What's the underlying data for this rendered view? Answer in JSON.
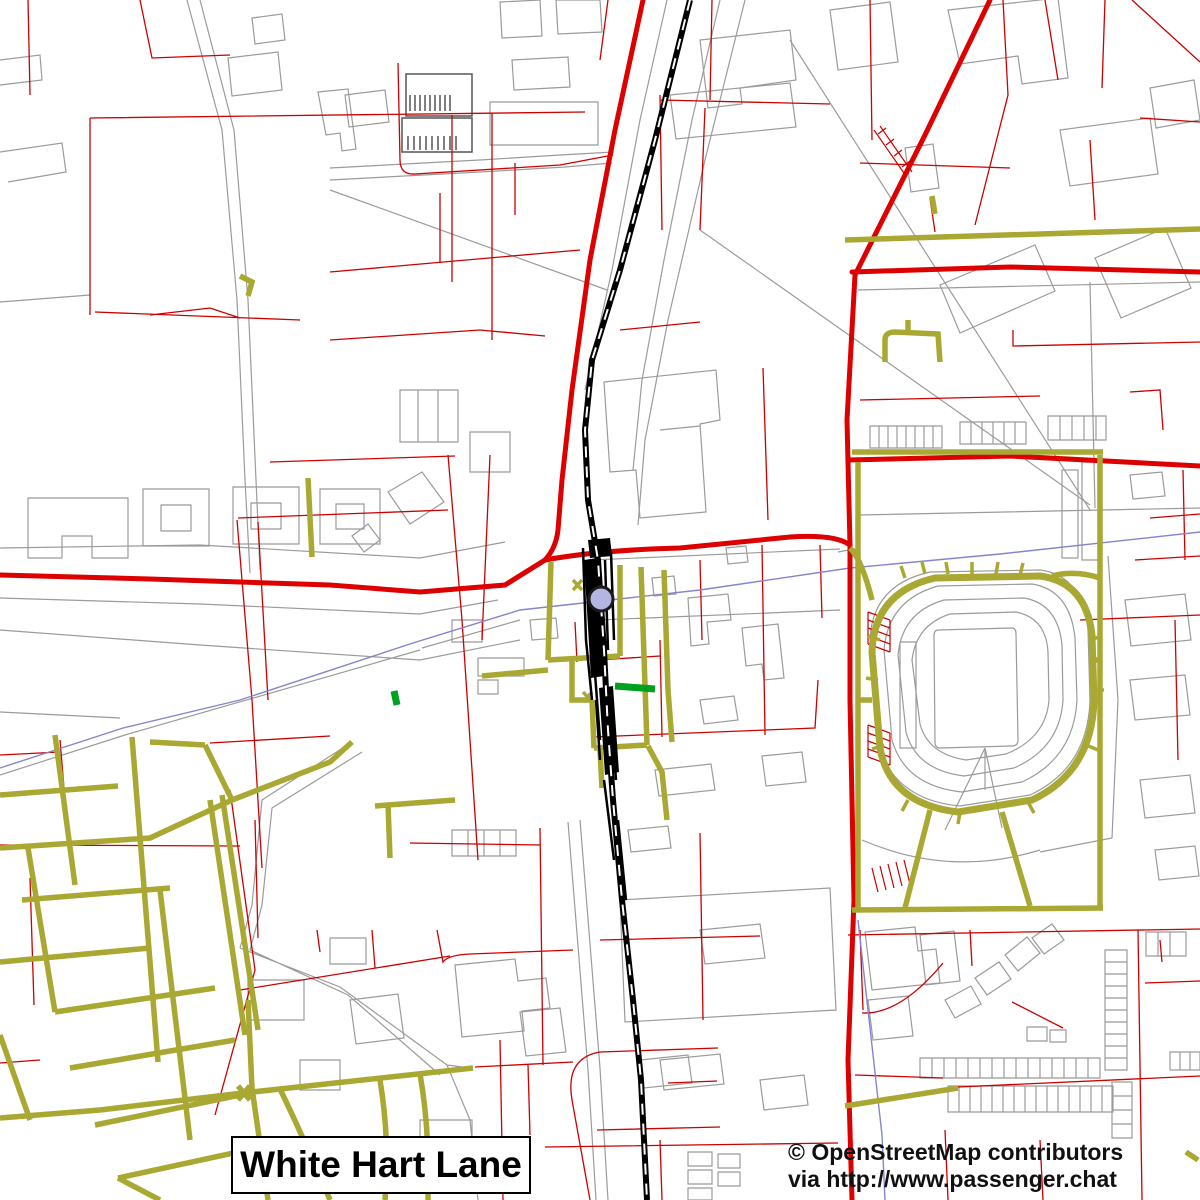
{
  "title": {
    "label": "White Hart Lane"
  },
  "attribution": {
    "line1": "© OpenStreetMap contributors",
    "line2": "via http://www.passenger.chat"
  },
  "colors": {
    "background": "#ffffff",
    "primary_road": "#dd0000",
    "minor_road": "#cc0000",
    "footpath": "#a8a832",
    "railway": "#000000",
    "water_boundary": "#8585cc",
    "building_outline": "#9b9b9b",
    "station_marker_fill": "#b5b5e2",
    "station_marker_stroke": "#1a1a1a",
    "park_feature": "#00a020"
  },
  "map": {
    "viewbox": "0 0 1200 1200",
    "layers": [
      {
        "name": "parcel-and-building-outlines",
        "color": "#9b9b9b",
        "width": 1.2,
        "paths": [
          "M187,0 L222,130 L237,300 L245,480 L250,573 M200,0 L234,130 L248,300 L256,480 L260,570",
          "M745,0 L705,160 L668,320 L645,440 L638,525 M720,0 L692,120 L664,260 L642,380 L633,470",
          "M667,0 L640,120 L612,270 L585,390",
          "M0,548 L200,545 L420,558 L505,542 M0,598 L200,604 L420,614 L498,600",
          "M330,168 L480,160 L560,155 L614,152 M330,180 L480,172 L565,167 L612,163",
          "M330,190 L607,290 M0,302 L90,295 M0,152 L62,143 L66,172 L8,182",
          "M352,742 L262,800 L252,905 L240,948 M362,752 L272,808 L262,905 L250,950 M240,948 L340,987 L447,1065 L470,1120 L478,1200 M250,950 L348,995 L440,1075 M447,1065 L470,1068",
          "M568,822 L588,1070 L596,1200 M580,820 L600,1068 L608,1200",
          "M0,630 L200,645 L420,660 L520,640 M0,712 L120,718 M420,650 L125,735 L0,775 M520,620 L422,648",
          "M143,489 h66 v57 h-66 z M161,505 h30 v26 h-30 z M233,487 h66 v57 h-66 z M251,503 h30 v26 h-30 z M320,489 h60 v55 h-60 z M336,504 h28 v25 h-28 z M28,498 h100 v60 h-36 v-22 h-30 v22 h-34 z M388,492 l34,-20 22,30 -34,22 z M352,536 l16,-12 12,16 -16,12 z",
          "M228,58 l50,-6 4,38 -50,6 z M252,18 l30,-4 3,26 -30,4 z M318,92 l30,-3 8,60 -14,2 -2,-18 -14,2 z M500,2 l40,-2 2,36 -40,2 z M556,0 h44 l2,32 -44,2 z M0,60 L40,55 L42,80 L0,85",
          "M490,102 h108 v43 h-108 z M512,60 l56,-3 2,30 -56,3 z M345,95 l40,-5 4,32 -40,5 z",
          "M700,40 l90,-10 6,50 -56,8 2,16 -34,4 z M830,10 l60,-8 8,60 -60,8 z M905,148 l28,-4 6,44 -28,4 z M948,10 l110,-12 10,80 -46,6 -4,-28 -58,8 z M1060,130 l90,-12 8,56 -88,12 z M1150,88 l44,-8 6,40 -44,8 z M940,285 l95,-40 20,46 -95,42 z M1095,258 l70,-30 26,60 -70,30 z",
          "M790,40 L1090,510 M700,230 L1090,505 M858,290 L1200,282 M858,515 L1200,508 M1090,282 L1095,508",
          "M870,426 h72 v22 h-72 z M879,426 v22 m9,-22 v22 m9,-22 v22 m9,-22 v22 m9,-22 v22 m9,-22 v22 m9,-22 v22",
          "M960,422 h66 v22 h-66 z M971,422 v22 m11,-22 v22 m11,-22 v22 m11,-22 v22 m11,-22 v22",
          "M1048,416 h58 v24 h-58 z M1060,416 v24 m12,-24 v24 m12,-24 v24 m12,-24 v24",
          "M604,382 L716,370 L720,420 L700,424 L706,512 L640,518 L636,470 L610,472 Z M660,430 L700,426 M670,95 l120,-12 6,44 -120,12 z",
          "M400,390 h58 v52 h-58 z M418,390 v52 M438,390 v52 M470,432 h40 v40 h-40 z M452,620 h30 v22 h-30 z M478,658 h46 v18 h-46 z M478,680 h20 v14 h-20 z M530,620 l26,-2 2,20 -26,2 z",
          "M688,598 l40,-4 3,26 -24,2 2,22 -18,2 z M742,628 l36,-4 6,54 -20,2 -2,-16 -16,2 z M652,578 l22,-2 2,18 -22,2 z M726,548 l20,-2 2,16 -20,2 z M655,770 l56,-6 4,26 -56,6 z M762,756 l40,-4 4,30 -40,4 z M700,700 l34,-4 4,24 -34,4 z M592,560 L840,549 M598,620 L840,610",
          "M870,640 Q872,585 930,572 L1040,570 Q1082,575 1088,630 L1090,700 Q1088,768 1030,795 L960,806 Q895,800 878,745 Z",
          "M884,650 Q888,600 938,586 L1032,584 Q1070,590 1075,638 L1077,700 Q1074,758 1022,782 L962,792 Q905,786 892,740 Z",
          "M898,655 Q902,612 944,600 L1024,598 Q1058,604 1062,645 L1063,700 Q1060,748 1014,768 L964,776 Q916,770 906,732 Z",
          "M912,660 Q916,625 950,614 L1016,612 Q1046,618 1048,652 L1049,700 Q1046,738 1006,754 L966,760 Q928,754 920,724 Z",
          "M938,630 L1012,628 Q1016,628 1016,634 L1018,740 Q1018,746 1012,746 L940,748 Q935,748 935,742 L934,636 Q934,630 938,630 M900,642 h16 v106 h-16 z",
          "M985,748 L945,830 M985,748 L1002,828 M985,748 L985,790",
          "M838,552 L860,548 M1108,556 L1118,700 L1112,838 L1040,852 M862,840 Q950,878 1040,850",
          "M1125,600 l60,-6 6,46 -60,6 z M1130,680 l55,-5 5,40 -55,5 z M1140,780 l50,-5 5,38 -50,5 z M1155,850 l40,-4 4,30 -40,4 z M1062,470 h16 v88 h-16 z M1082,462 h16 v98 h-16 z M1130,475 l32,-3 3,24 -32,3 z",
          "M620,900 L830,888 L836,1010 L625,1022 Z M455,965 l60,-6 3,22 28,-3 4,30 -28,3 2,20 -62,6 z M520,1012 l40,-4 6,44 -40,4 z M248,980 h56 v40 h-56 z M350,1000 l48,-6 6,44 -48,6 z M300,1060 h40 v30 h-40 z M420,1120 h52 v36 h-52 z M330,938 h36 v26 h-36 z M660,1060 l60,-6 4,30 -60,6 z",
          "M452,830 h64 v26 h-64 z M468,830 v26 m16,-26 v26 m16,-26 v26 M688,1152 h24 v14 h-24 z M688,1170 h24 v14 h-24 z M688,1188 h24 v12 h-24 z M718,1154 h22 v14 h-22 z M718,1172 h22 v14 h-22 z",
          "M865,932 l50,-5 3,24 18,-2 4,34 -68,7 z M868,1000 l40,-4 5,40 -40,4 z M920,935 l34,-4 6,50 -34,4 z",
          "M945,1000 l26,-14 10,18 -26,14 z M975,978 l24,-16 12,17 -24,16 z M1005,955 l22,-18 13,16 -22,18 z M1032,938 l20,-14 12,16 -20,14 z M1027,1027 h20 v14 h-20 z M1050,1030 h16 v12 h-16 z",
          "M920,1058 h180 v20 h-180 z M932,1058 v20 m12,-20 v20 m12,-20 v20 m12,-20 v20 m12,-20 v20 m12,-20 v20 m12,-20 v20 m12,-20 v20 m12,-20 v20 m12,-20 v20 m12,-20 v20 m12,-20 v20 m12,-20 v20 m12,-20 v20",
          "M948,1086 h165 v26 h-165 z M959,1086 v26 m11,-26 v26 m11,-26 v26 m11,-26 v26 m11,-26 v26 m11,-26 v26 m11,-26 v26 m11,-26 v26 m11,-26 v26 m11,-26 v26 m11,-26 v26 m11,-26 v26 m11,-26 v26 m11,-26 v26",
          "M1105,950 h22 v120 h-22 z M1105,962 h22 m-22,12 h22 m-22,12 h22 m-22,12 h22 m-22,12 h22 m-22,12 h22 m-22,12 h22 m-22,12 h22 m-22,12 h22",
          "M1112,1082 h20 v56 h-20 z M1112,1096 h20 M1112,1110 h20 M1112,1124 h20 M1146,932 h40 v24 h-40 z M1158,932 v24 m12,-24 v24 M1170,1052 h30 v18 h-30 z M1180,1052 v18 m10,-18 v18",
          "M640,1060 l48,-5 4,28 -48,5 z M628,830 l40,-4 3,22 -40,4 z M700,930 l60,-6 5,34 -60,6 z M760,1080 l44,-5 4,30 -44,5 z"
        ]
      },
      {
        "name": "building-hatch-detail",
        "color": "#555555",
        "width": 1.5,
        "paths": [
          "M406,74 h66 v42 h-66 z M410,95 v16 m5,-16 v16 m5,-16 v16 m5,-16 v16 m5,-16 v16 m5,-16 v16 m5,-16 v16 m5,-16 v16 m5,-16 v16",
          "M402,118 h70 v34 h-70 z M408,136 v14 m6,-14 v14 m6,-14 v14 m6,-14 v14 m6,-14 v14 m6,-14 v14 m6,-14 v14 m6,-14 v14 m6,-14 v14"
        ]
      },
      {
        "name": "minor-roads",
        "color": "#cc0000",
        "width": 1.3,
        "paths": [
          "M90,118 L585,112 M90,118 L90,315 M452,115 L452,282 M492,113 L492,340 M95,312 L300,320 M150,315 L210,308 L240,318 M28,0 L30,95 M140,0 L152,58 L230,55",
          "M237,520 L252,700 L262,868 M258,522 L268,700 M448,455 L462,620 L478,860 M490,455 L482,640 M270,462 L455,456 M238,518 L448,510",
          "M398,63 L400,160 Q400,175 415,174 L560,165 L613,155 M330,272 L580,250 M440,193 L440,263 M515,163 L515,215 M330,340 L480,330 L545,336",
          "M608,0 L600,60 M660,100 L830,104 M712,0 L710,100 M705,108 L700,230 M660,95 L662,230 M763,368 L768,520 M620,330 L700,322",
          "M870,0 L872,140 M1003,0 L1008,95 L975,225 M930,198 L935,232 M860,163 L1010,168 M1105,0 L1102,88 M1045,0 L1058,80 M1140,118 L1200,122 M1132,0 L1200,62 M1090,140 L1095,220",
          "M1013,330 L1013,346 L1200,342 M860,400 L1040,396 M1130,392 L1160,390 L1163,430 M1183,470 L1185,560 M1135,560 L1200,556 M1080,620 L1200,615 M1150,518 L1200,514 M1175,620 L1178,760",
          "M592,737 L815,728 L818,680 M700,560 L702,640 M762,545 L765,735 M660,640 L662,737 M820,545 L822,618 M598,660 L660,656",
          "M575,622 L577,662 M560,660 L592,657",
          "M30,878 L34,1005 M0,845 L240,846 M0,755 L60,752 M210,743 L330,736 M230,790 L255,970 L215,1115 M60,740 L65,800 M0,1063 L40,1060",
          "M255,820 L258,938 M540,828 L543,1065 M410,843 L540,845 M545,1147 L838,1143 M500,1040 L503,1200 M660,1140 L662,1200 M700,833 L703,1020 M600,940 L760,936 M597,1130 L720,1127 M590,1200 L572,1100 Q565,1058 600,1052 L718,1048 M668,1083 L717,1081",
          "M317,930 L320,952 M372,930 L375,968 M437,930 L443,962 Q448,955 470,954 L573,950 M240,990 L450,956 M475,1067 L573,1062 M528,1065 L530,1135",
          "M848,935 L1200,929 M958,1087 L1200,1076 M943,963 Q900,1015 862,1013 M970,930 L972,966 M1012,1002 L1063,1028 M1138,930 L1142,1200 M1145,983 L1200,981 M1160,940 L1162,962 M945,1130 L948,1200 M1040,1140 L1043,1200 M860,930 L863,1010 M855,1075 L943,1078"
        ]
      },
      {
        "name": "steps-hatching",
        "color": "#cc0000",
        "width": 1.2,
        "paths": [
          "M868,612 L890,620 M868,620 L890,628 M868,628 L890,636 M868,636 L890,644 M868,644 L890,652 M868,612 L868,644 M890,620 L890,652",
          "M868,725 L890,733 M868,733 L890,741 M868,741 L890,749 M868,749 L890,757 M868,757 L890,765 M868,725 L868,757 M890,733 L890,765",
          "M872,868 L878,892 M880,866 L886,890 M888,864 L894,888 M896,862 L902,886 M904,860 L910,884",
          "M874,130 L906,176 M880,126 L912,172 M878,134 l8,-6 M886,145 l8,-6 M894,156 l8,-6 M902,167 l8,-6"
        ]
      },
      {
        "name": "boundary-waterway",
        "color": "#8585cc",
        "width": 1.4,
        "paths": [
          "M1200,532 L1000,554 L850,568 L700,590 L601,601 L520,610 L413,643 L240,700 L123,728 L0,768",
          "M858,920 L868,1010 L882,1135 L885,1200"
        ]
      },
      {
        "name": "primary-roads",
        "color": "#dd0000",
        "width": 5,
        "cap": "round",
        "paths": [
          "M643,0 L615,130 L590,260 L572,390 L562,480 L558,530 Q556,548 545,560 L505,585 L420,592 L330,585 L150,579 L0,575",
          "M545,560 Q600,550 680,548 L790,537 Q835,534 850,545",
          "M990,0 L925,135 L855,275 L847,420 L850,545 L850,700 L854,900 L848,1060 L852,1200",
          "M852,272 L1010,267 L1200,272",
          "M848,460 L1010,456 L1200,466"
        ]
      },
      {
        "name": "footpaths",
        "color": "#a8a832",
        "width": 5.5,
        "paths": [
          "M0,795 L118,786 M0,848 L150,838 L232,800 M22,900 L170,888 M0,962 L150,948 M55,1012 L215,988 M70,1068 L235,1040 M95,1125 L255,1092 M118,1178 L270,1145 M55,735 L75,885 M132,737 L158,1062 M205,745 L232,800 M210,800 L245,1035 M222,795 L258,1030 M28,848 L55,1012 M160,890 L190,1140 M118,1178 L160,1200 M270,1145 L330,1190 M150,742 L205,745 M232,800 L330,762 L352,742 M248,1000 L252,1088 L268,1200 M0,1035 L30,1120",
          "M0,1118 L100,1110 L243,1093 L473,1068 M280,1089 Q300,1130 330,1200 M420,1074 Q430,1130 428,1200 M380,1080 Q390,1140 385,1200 M238,1086 L250,1100 M250,1086 L238,1100",
          "M308,478 L312,557 M240,276 L252,282 L248,296 M375,806 L455,800 M388,804 L390,858 M482,676 L548,670",
          "M551,562 L548,660 M548,660 L620,656 M620,565 L620,656 M641,567 L647,745 M594,748 L647,745 M592,700 L594,748 M572,660 L572,700 L592,700 M664,570 L668,690 M668,690 L672,742 M648,746 L662,772 L667,820 M600,750 L602,788",
          "M852,452 L1103,452 M858,462 L858,910 M1100,455 L1100,908 M852,910 L1103,908",
          "M850,548 Q862,560 872,600 M1052,576 Q1075,570 1100,578 M930,810 L905,908 M1002,812 L1030,906 M1094,660 L1100,660 M872,700 L858,700",
          "M845,240 L1200,229 M932,196 L935,214 M885,362 L885,340 Q885,332 895,332 L938,334 L940,362 M908,332 L908,320 M1186,1152 L1198,1160 M845,1106 L958,1088"
        ]
      },
      {
        "name": "stadium-ring-path",
        "color": "#a8a832",
        "width": 7,
        "paths": [
          "M872,652 Q874,592 935,578 L1040,576 Q1086,582 1092,635 L1094,700 Q1092,772 1032,800 L958,812 Q890,804 880,748 Z"
        ]
      },
      {
        "name": "footpath-ticks",
        "color": "#a8a832",
        "width": 3.5,
        "paths": [
          "M905,578 l-4,-12 M925,574 l-3,-12 M948,574 l-2,-12 M972,574 l0,-12 M996,574 l2,-12 M1020,575 l3,-12 M880,640 l-12,-4 M878,680 l-12,-2 M884,745 l-12,4 M1090,640 l12,-4 M1092,690 l12,0 M1086,745 l12,5 M908,800 l-6,11 M960,812 l-2,12 M1028,802 l6,11",
          "M573,580 L582,590 M582,580 L573,590 M583,692 L592,702 M592,692 L583,702"
        ]
      },
      {
        "name": "railway-casing",
        "color": "#000000",
        "width": 6,
        "paths": [
          "M690,0 L655,140 L620,270 L592,360 L585,430 L588,500 L598,560 L604,650 L608,730 L613,800 L622,900 L633,1000 L641,1080 L647,1200"
        ]
      },
      {
        "name": "railway-sidings",
        "color": "#000000",
        "width": 2.5,
        "paths": [
          "M583,548 L586,640 L592,700 M611,552 L614,640 M590,560 L594,660 L600,740 M605,560 L608,650 M596,700 L600,760 M610,700 L616,780 M604,780 L614,860 M618,820 L626,900"
        ]
      },
      {
        "name": "station-platforms",
        "color": "none",
        "fill": "#000000",
        "width": 0,
        "paths": [
          "M584,560 L597,558 L604,676 L591,678 Z M599,688 L613,686 L619,772 L605,775 Z M588,540 L610,538 L612,556 L590,558 Z"
        ]
      },
      {
        "name": "railway-dashes",
        "color": "#ffffff",
        "width": 2,
        "dash": "11 9",
        "paths": [
          "M690,0 L655,140 L620,270 L592,360 L585,430 L588,500 L598,560 L604,650 L608,730 L613,800 L622,900 L633,1000 L641,1080 L647,1200"
        ]
      },
      {
        "name": "park-features",
        "color": "#00a020",
        "width": 7,
        "paths": [
          "M615,686 L655,689",
          "M394,691 L397,705"
        ]
      }
    ],
    "markers": [
      {
        "name": "station-marker",
        "cx": 601,
        "cy": 599,
        "r": 12,
        "fill": "#b5b5e2",
        "stroke": "#1a1a1a",
        "stroke_width": 3
      }
    ]
  }
}
